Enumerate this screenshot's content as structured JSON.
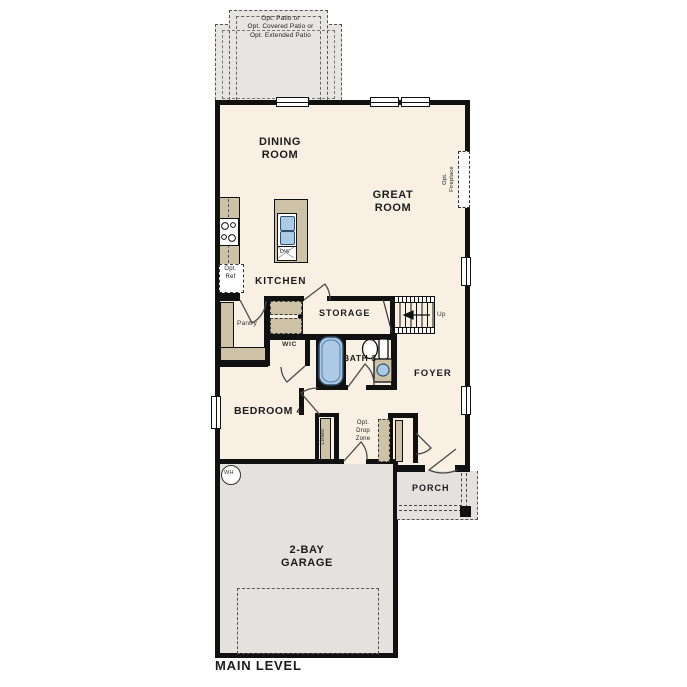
{
  "plan": {
    "title": "MAIN LEVEL",
    "patio": {
      "line1": "Opt. Patio or",
      "line2": "Opt. Covered Patio or",
      "line3": "Opt. Extended Patio"
    },
    "rooms": {
      "dining": {
        "line1": "DINING",
        "line2": "ROOM"
      },
      "great": {
        "line1": "GREAT",
        "line2": "ROOM"
      },
      "kitchen": "KITCHEN",
      "storage": "STORAGE",
      "foyer": "FOYER",
      "bedroom4": "BEDROOM 4",
      "bath3": "BATH 3",
      "wic": "WIC",
      "pantry": "Pantry",
      "porch": "PORCH",
      "garage": {
        "line1": "2-BAY",
        "line2": "GARAGE"
      }
    },
    "annotations": {
      "up": "Up",
      "opt_ref": {
        "line1": "Opt.",
        "line2": "Ref"
      },
      "dw": "DW",
      "wh": "WH",
      "linen": "Linen",
      "drop_zone": {
        "line1": "Opt.",
        "line2": "Drop",
        "line3": "Zone"
      },
      "fireplace": {
        "line1": "Opt.",
        "line2": "Fireplace"
      }
    },
    "colors": {
      "wall": "#111111",
      "floor": "#f8f1e3",
      "hard_surface": "#e6e5e2",
      "cabinet": "#cdc1a6",
      "fixture_blue": "#aacae6"
    }
  }
}
